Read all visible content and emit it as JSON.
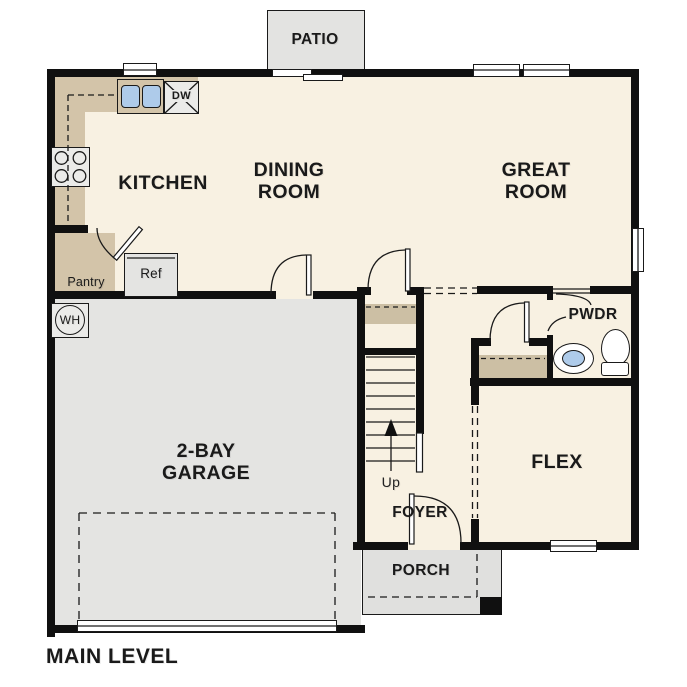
{
  "title": "MAIN LEVEL",
  "rooms": {
    "patio": "PATIO",
    "kitchen": "KITCHEN",
    "dining": [
      "DINING",
      "ROOM"
    ],
    "great": [
      "GREAT",
      "ROOM"
    ],
    "garage": [
      "2-BAY",
      "GARAGE"
    ],
    "flex": "FLEX",
    "foyer": "FOYER",
    "porch": "PORCH",
    "powder": "PWDR",
    "pantry": "Pantry"
  },
  "fixtures": {
    "refrigerator": "Ref",
    "dishwasher": "DW",
    "water_heater": "WH",
    "stairs_direction": "Up"
  },
  "colors": {
    "wall": "#101010",
    "floor": "#f8f1e2",
    "garage_floor": "#e4e4e2",
    "patio_floor": "#e3e3e1",
    "porch_floor": "#e0e0de",
    "counter": "#d3c4a9",
    "shelf": "#ccbfa4",
    "sink_blue": "#aecbea",
    "appliance_gray": "#ebebe9",
    "text": "#1a1a1a"
  }
}
